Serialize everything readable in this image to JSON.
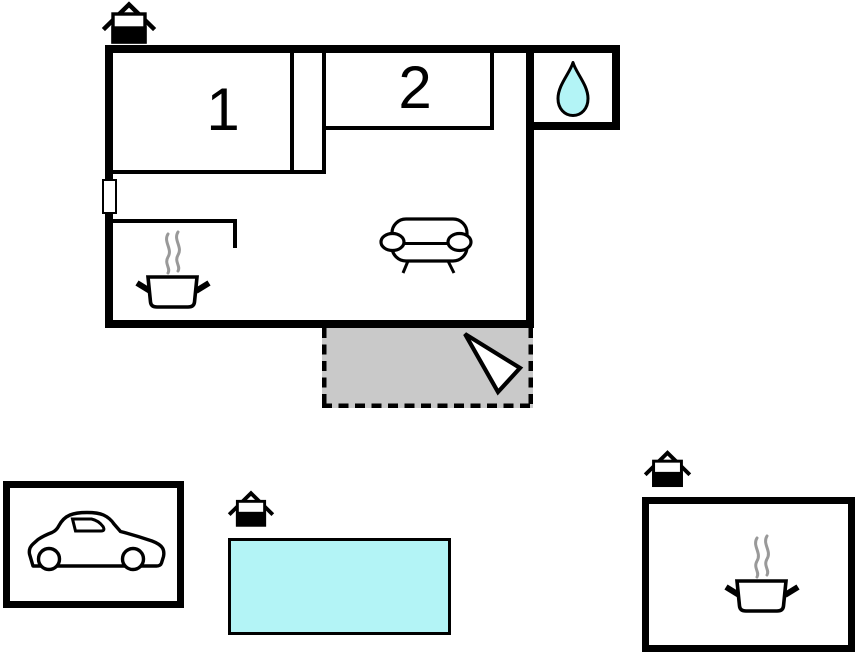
{
  "rooms": [
    {
      "label": "1"
    },
    {
      "label": "2"
    }
  ],
  "icons": {
    "bathroom": "water-drop",
    "kitchen": "cooking-pot",
    "living_room": "sofa",
    "terrace": "entrance-arrow",
    "garage": "car",
    "annex": "cooking-pot",
    "building_marker": "house"
  },
  "colors": {
    "wall": "#000000",
    "terrace_fill": "#c9c9c9",
    "water_fill": "#b3f4f6",
    "steam": "#999999",
    "background": "#ffffff"
  }
}
